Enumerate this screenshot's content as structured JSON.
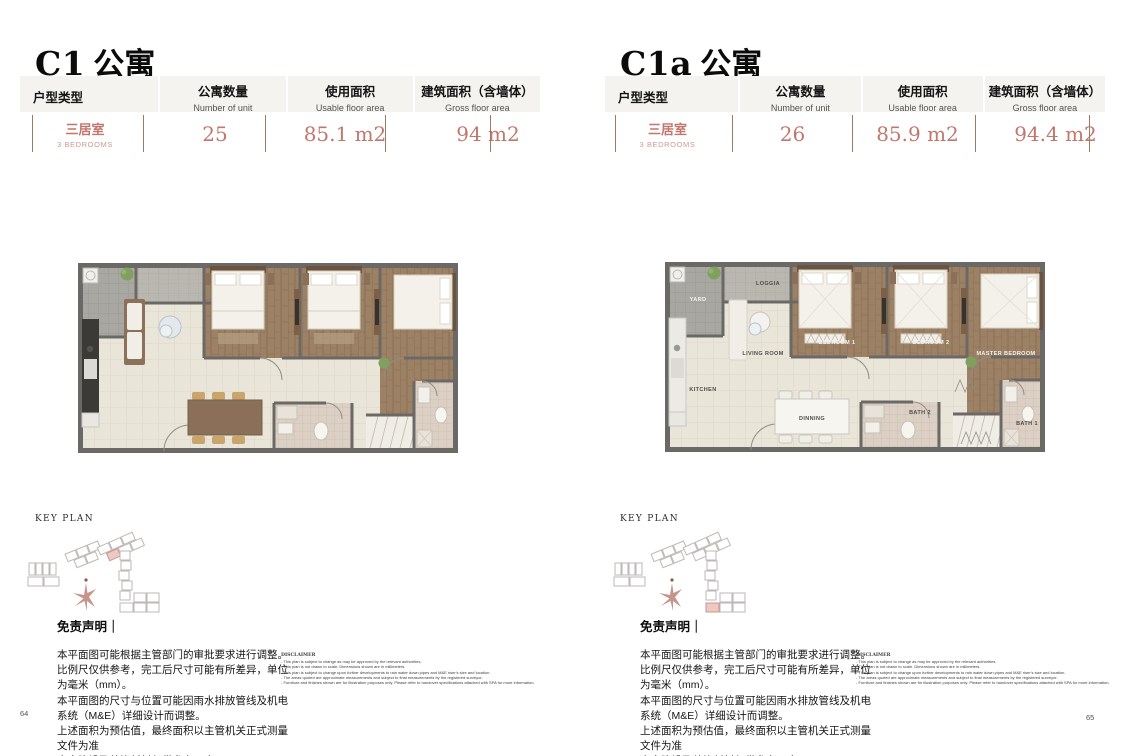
{
  "shared": {
    "key_plan_label": "KEY PLAN",
    "table_columns": [
      {
        "zh": "户型类型",
        "en": "Unit type"
      },
      {
        "zh": "公寓数量",
        "en": "Number of unit"
      },
      {
        "zh": "使用面积",
        "en": "Usable floor area"
      },
      {
        "zh": "建筑面积（含墙体）",
        "en": "Gross floor area"
      }
    ],
    "disclaimer_zh_title": "免责声明｜",
    "disclaimer_zh": "本平面图可能根据主管部门的审批要求进行调整。\n比例尺仅供参考，完工后尺寸可能有所差异，单位为毫米（mm）。\n本平面图的尺寸与位置可能因雨水排放管线及机电系统（M&E）详细设计而调整。\n上述面积为预估值，最终面积以主管机关正式测量文件为准\n室内陈设及装饰材料仅供参考示意。\n详情请参阅买卖合同所附之技术规格文件。",
    "disclaimer_en_title": "DISCLAIMER",
    "disclaimer_en": "- This plan is subject to change as may be approved by the relevant authorities.\n- This plan is not drawn to scale. Dimensions shown are in millimeters.\n- This plan is subject to change upon further developments to rain water down pipes and M&E riser's size and location.\n- The areas quoted are approximate measurements and subject to final measurements by the registered surveyor.\n- Furniture and finishes shown are for illustration purposes only. Please refer to handover specifications attached with SPA for more information."
  },
  "left_panel": {
    "title_latin": "C1",
    "title_cjk": "公寓",
    "unit_type_zh": "三居室",
    "unit_type_en": "3 BEDROOMS",
    "number_of_units": "25",
    "usable_area": "85.1 m2",
    "gross_area": "94 m2",
    "page_number": "64"
  },
  "right_panel": {
    "title_latin": "C1a",
    "title_cjk": "公寓",
    "unit_type_zh": "三居室",
    "unit_type_en": "3 BEDROOMS",
    "number_of_units": "26",
    "usable_area": "85.9 m2",
    "gross_area": "94.4 m2",
    "page_number": "65",
    "plan_labels": {
      "loggia": "LOGGIA",
      "yard": "YARD",
      "living_room": "LIVING ROOM",
      "kitchen": "KITCHEN",
      "dining": "DINNING",
      "bedroom1": "BEDROOM 1",
      "bedroom2": "BEDROOM 2",
      "master_bedroom": "MASTER BEDROOM",
      "bath2": "BATH 2",
      "bath1": "BATH 1"
    }
  },
  "colors": {
    "accent_value_text": "#c1776d",
    "divider_brown": "#9c7a63",
    "table_header_bg": "#f4f3f0",
    "wall_gray": "#6b6965",
    "floor_beige": "#eae5d9",
    "wood_brown": "#9c8164",
    "keyplan_highlight": "#eec9c4",
    "compass_star": "#c8938a"
  }
}
